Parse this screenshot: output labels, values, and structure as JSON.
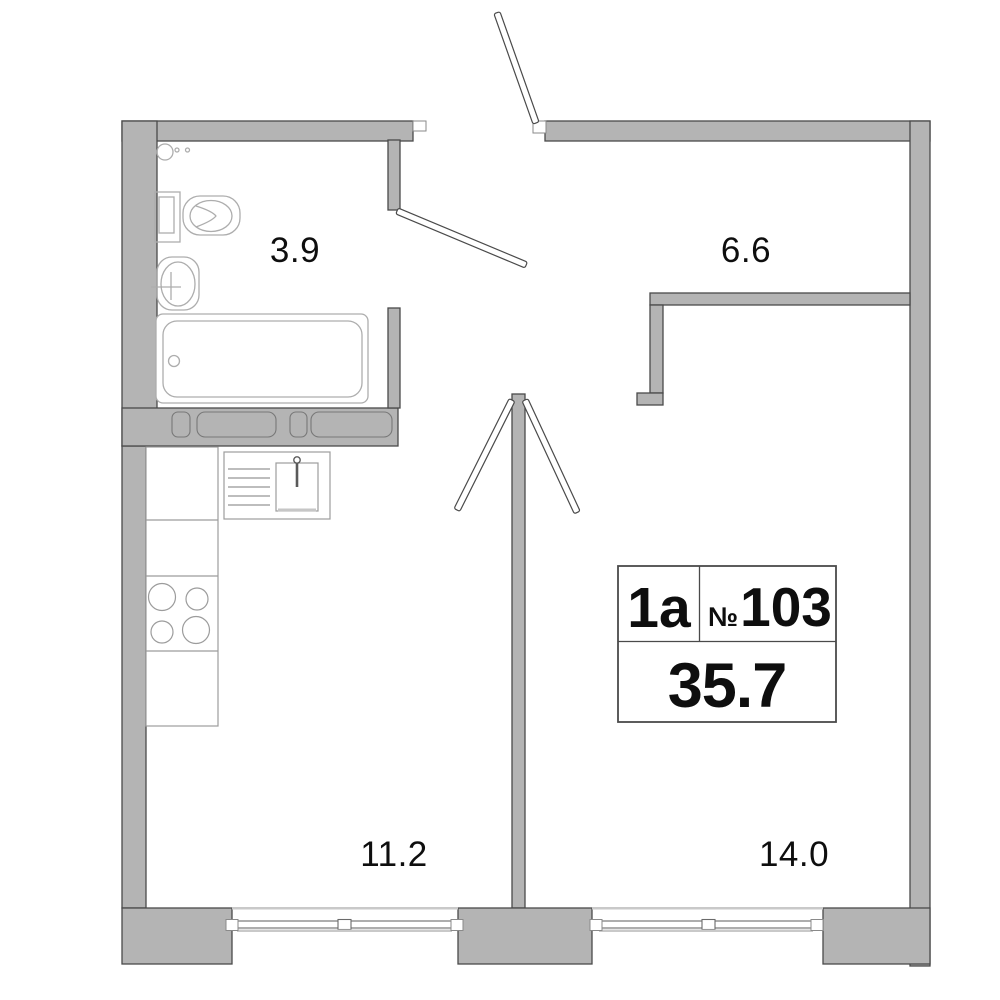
{
  "unit": {
    "type_label": "1a",
    "number_sign": "№",
    "number": "103",
    "total_area": "35.7"
  },
  "rooms": {
    "bathroom": {
      "area": "3.9"
    },
    "hallway": {
      "area": "6.6"
    },
    "kitchen": {
      "area": "11.2"
    },
    "living_room": {
      "area": "14.0"
    }
  },
  "colors": {
    "wall_fill": "#b4b4b4",
    "wall_outline": "#4a4a4a",
    "fixture_outline": "#adadad",
    "window_light_gray": "#c9c9c9",
    "label_text": "#0e0e0e"
  }
}
